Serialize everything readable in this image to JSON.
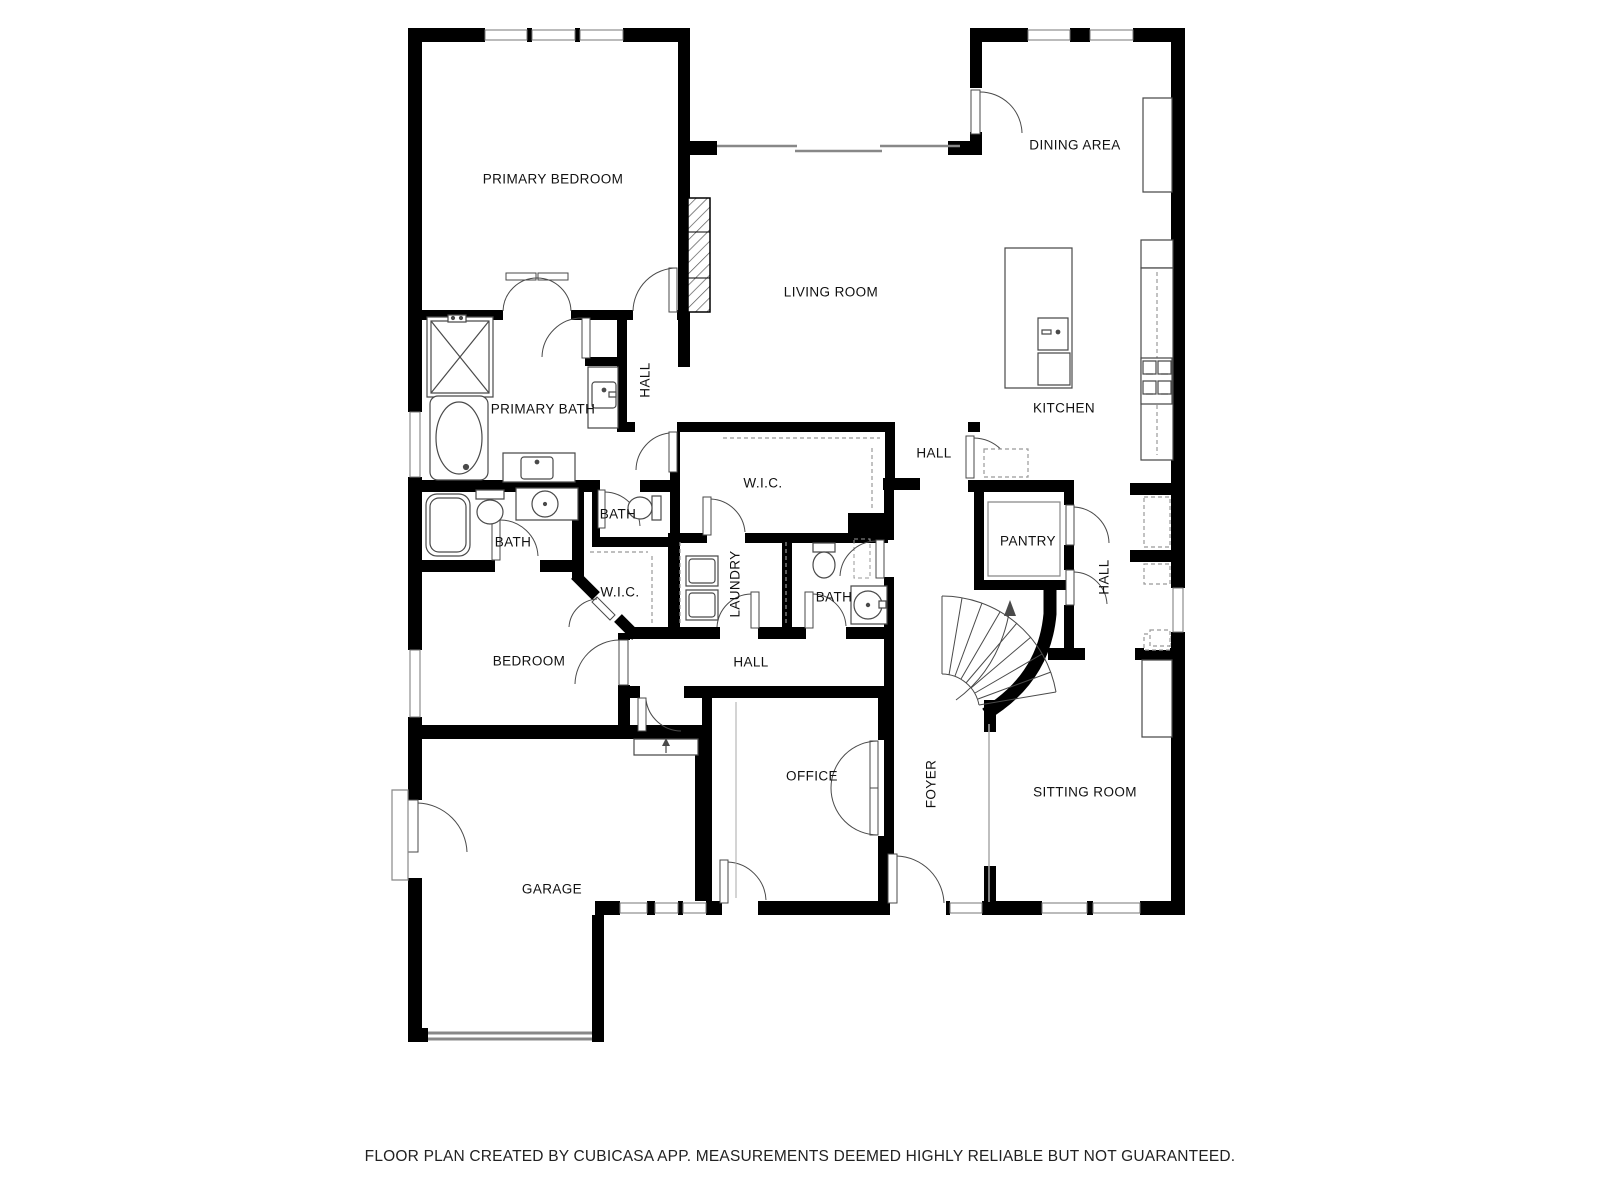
{
  "disclaimer": "FLOOR PLAN CREATED BY CUBICASA APP. MEASUREMENTS DEEMED HIGHLY RELIABLE BUT NOT GUARANTEED.",
  "rooms": [
    {
      "label": "PRIMARY BEDROOM"
    },
    {
      "label": "DINING AREA"
    },
    {
      "label": "LIVING ROOM"
    },
    {
      "label": "KITCHEN"
    },
    {
      "label": "PRIMARY BATH"
    },
    {
      "label": "HALL"
    },
    {
      "label": "HALL"
    },
    {
      "label": "W.I.C."
    },
    {
      "label": "BATH"
    },
    {
      "label": "BATH"
    },
    {
      "label": "PANTRY"
    },
    {
      "label": "HALL"
    },
    {
      "label": "W.I.C."
    },
    {
      "label": "LAUNDRY"
    },
    {
      "label": "BATH"
    },
    {
      "label": "BEDROOM"
    },
    {
      "label": "HALL"
    },
    {
      "label": "OFFICE"
    },
    {
      "label": "FOYER"
    },
    {
      "label": "SITTING ROOM"
    },
    {
      "label": "GARAGE"
    }
  ],
  "icons": {
    "stairs_direction_arrow": "up",
    "garage_step_arrow": "up"
  },
  "colors": {
    "wall": "#000000",
    "door_fixture": "#4a4a4a",
    "window": "#8c8c8c",
    "dashed_detail": "#999999",
    "text": "#111111",
    "background": "#ffffff"
  }
}
